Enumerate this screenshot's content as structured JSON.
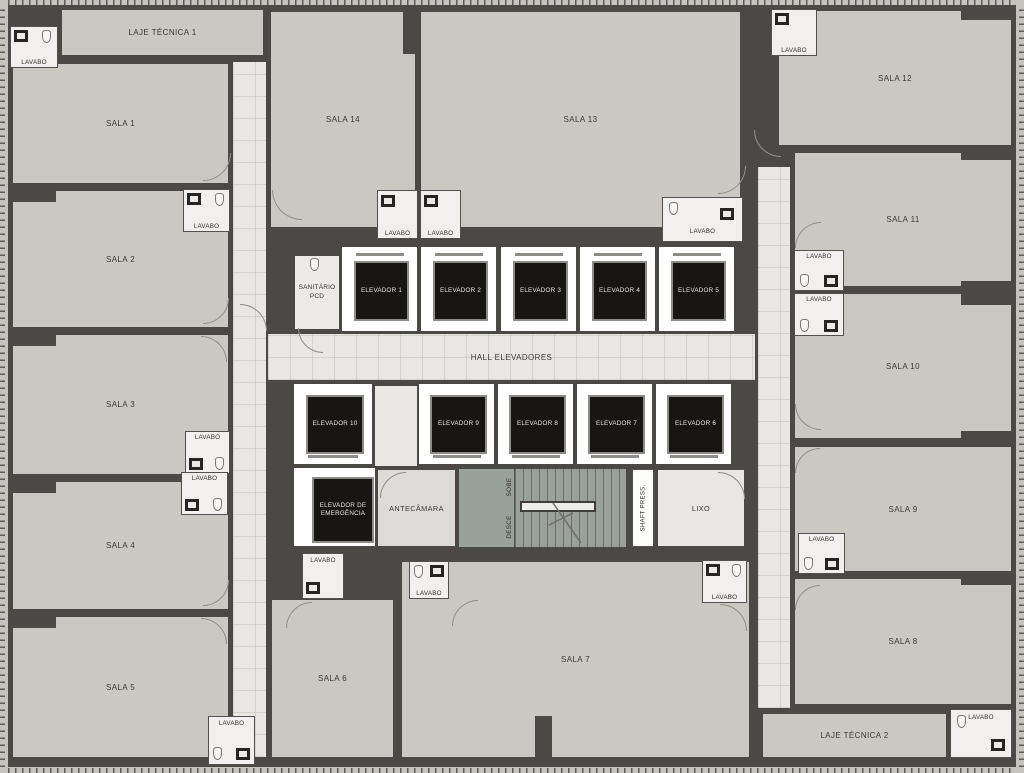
{
  "plan": {
    "type": "office-floor-plan",
    "rooms": {
      "laje_tecnica_1": "LAJE TÉCNICA 1",
      "laje_tecnica_2": "LAJE TÉCNICA 2",
      "sala_1": "SALA 1",
      "sala_2": "SALA 2",
      "sala_3": "SALA 3",
      "sala_4": "SALA 4",
      "sala_5": "SALA 5",
      "sala_6": "SALA 6",
      "sala_7": "SALA 7",
      "sala_8": "SALA 8",
      "sala_9": "SALA 9",
      "sala_10": "SALA 10",
      "sala_11": "SALA 11",
      "sala_12": "SALA 12",
      "sala_13": "SALA 13",
      "sala_14": "SALA 14",
      "lavabo": "LAVABO",
      "sanitario_line1": "SANITÁRIO",
      "sanitario_line2": "PCD",
      "hall_elevadores": "HALL ELEVADORES",
      "antecamara": "ANTECÂMARA",
      "emergencia_line1": "ELEVADOR DE",
      "emergencia_line2": "EMERGÊNCIA",
      "sobe": "SOBE",
      "desce": "DESCE",
      "shaft_press": "SHAFT PRESS.",
      "lixo": "LIXO"
    },
    "elevators": [
      "ELEVADOR 1",
      "ELEVADOR 2",
      "ELEVADOR 3",
      "ELEVADOR 4",
      "ELEVADOR 5",
      "ELEVADOR 6",
      "ELEVADOR 7",
      "ELEVADOR 8",
      "ELEVADOR 9",
      "ELEVADOR 10"
    ],
    "colors": {
      "wall": "#4b4946",
      "room_fill": "#cbc8c3",
      "corridor_fill": "#e9e7e3",
      "elevator_cab": "#171614",
      "elevator_frame": "#ffffff",
      "stair_fill": "#9aa09b",
      "label_text": "#3b3a37"
    }
  }
}
